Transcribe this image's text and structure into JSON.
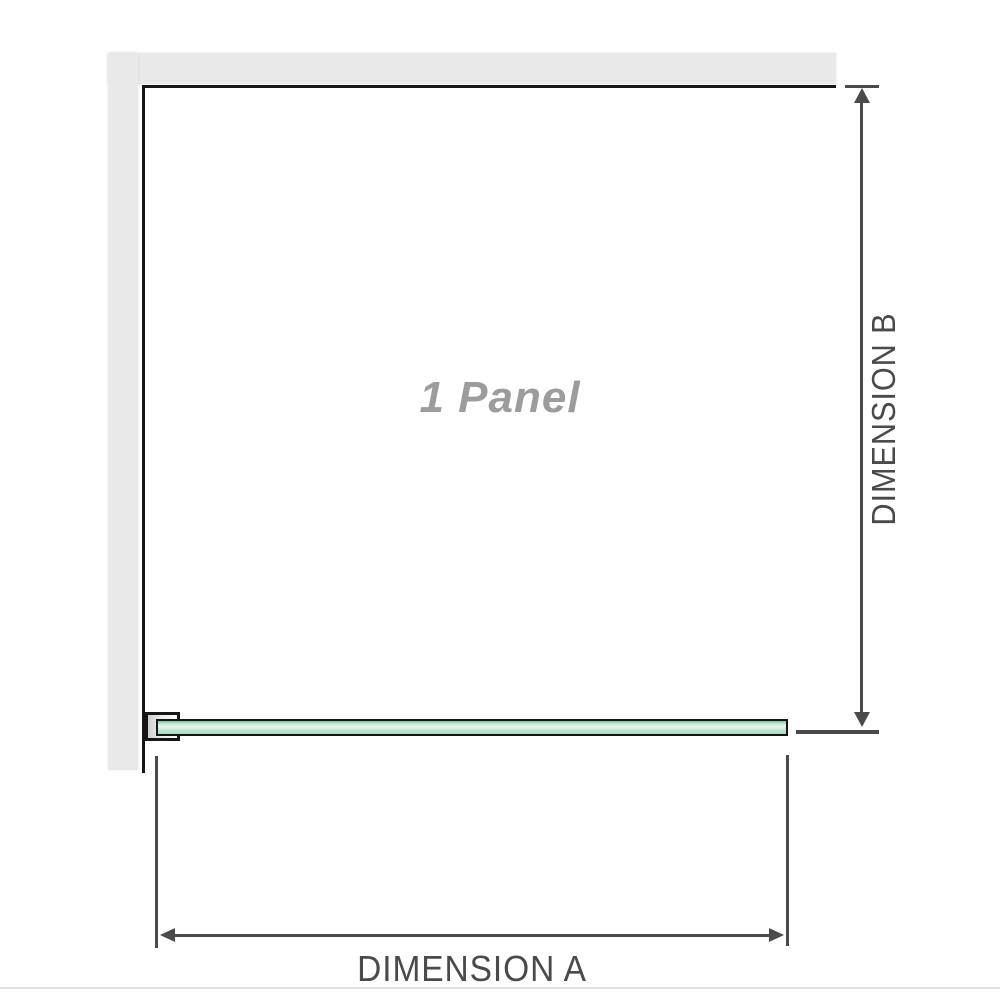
{
  "diagram": {
    "panel_label": "1 Panel",
    "dimension_a_label": "DIMENSION A",
    "dimension_b_label": "DIMENSION B"
  },
  "colors": {
    "wall": "#e9e9e9",
    "wall_edge": "#161616",
    "glass_border": "#161616",
    "glass_edge": "#7fc49d",
    "glass_light": "#d9f2e4",
    "glass_mid": "#bce5cd",
    "glass_dark": "#a4d9bd",
    "dimension": "#4a4a4a",
    "panel_text": "#9c9c9c",
    "baseline_rule": "#e4e2dd"
  }
}
